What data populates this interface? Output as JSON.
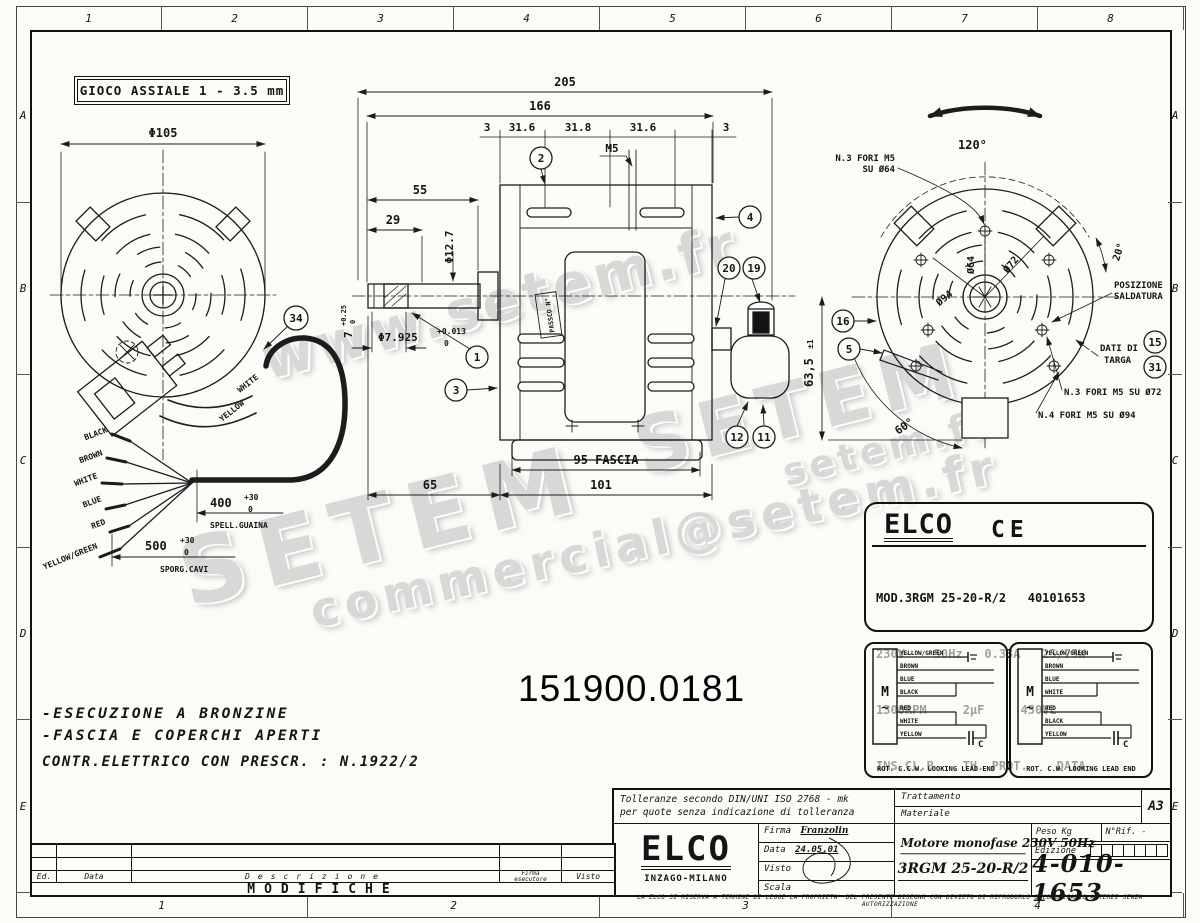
{
  "watermarks": {
    "w1": "www.setem.fr",
    "w2": "SETEM",
    "w3": "SETEM",
    "w4": "commercial@setem.fr",
    "w5": "setem.fr"
  },
  "border": {
    "top": [
      "1",
      "2",
      "3",
      "4",
      "5",
      "6",
      "7",
      "8"
    ],
    "bottom": [
      "1",
      "2",
      "3",
      "4"
    ],
    "left": [
      "A",
      "B",
      "C",
      "D",
      "E"
    ],
    "right": [
      "A",
      "B",
      "C",
      "D",
      "E"
    ]
  },
  "gioco": "GIOCO ASSIALE  1 - 3.5 mm",
  "part_number": "151900.0181",
  "notes": {
    "l1": "-ESECUZIONE A BRONZINE",
    "l2": "-FASCIA E COPERCHI APERTI",
    "l3": "CONTR.ELETTRICO CON PRESCR. : N.1922/2"
  },
  "left_view": {
    "dia": "Φ105",
    "callout34": "34",
    "terminal_white": "WHITE",
    "terminal_yellow": "YELLOW",
    "w1": "BLACK",
    "w2": "BROWN",
    "w3": "WHITE",
    "w4": "BLUE",
    "w5": "RED",
    "w6": "YELLOW/GREEN",
    "d400": {
      "v": "400",
      "up": "+30",
      "dn": "0",
      "label": "SPELL.GUAINA"
    },
    "d500": {
      "v": "500",
      "up": "+30",
      "dn": "0",
      "label": "SPORG.CAVI"
    }
  },
  "front_view": {
    "d205": "205",
    "d166": "166",
    "d3a": "3",
    "d316a": "31.6",
    "d318": "31.8",
    "d316b": "31.6",
    "d3b": "3",
    "m5": "M5",
    "d55": "55",
    "d29": "29",
    "d127": "Φ12.7",
    "shaft": {
      "v": "Φ7.925",
      "up": "+0.013",
      "dn": "0"
    },
    "key": {
      "v": "7",
      "up": "+0.25",
      "dn": "0"
    },
    "fascia": "95 FASCIA",
    "d65": "65",
    "d101": "101",
    "tag": "PASSCO N°",
    "c1": "1",
    "c2": "2",
    "c3": "3",
    "c4": "4",
    "c19": "19",
    "c20": "20",
    "c11": "11",
    "c12": "12"
  },
  "rear_view": {
    "a120": "120°",
    "a20": "20°",
    "a60": "60°",
    "d72": "Ø72",
    "d64": "Ø64",
    "d94": "Ø94",
    "d635": "63,5",
    "d635tol": "±1",
    "fori64a": "N.3 FORI M5",
    "fori64b": "SU Ø64",
    "pos1": "POSIZIONE",
    "pos2": "SALDATURA",
    "targa1": "DATI DI",
    "targa2": "TARGA",
    "fori72": "N.3 FORI M5 SU Ø72",
    "fori94": "N.4 FORI M5 SU Ø94",
    "c16": "16",
    "c5": "5",
    "c15": "15",
    "c31": "31"
  },
  "nameplate": {
    "brand": "ELCO",
    "ce": "CE",
    "l1": "MOD.3RGM 25-20-R/2   40101653",
    "l2": "230V~   50Hz   0.33A   25/75W",
    "l3": "1300RPM     2µF     450VL",
    "l4": "INS.CL.B    TH. PROT.    DATA"
  },
  "wiring": {
    "left": {
      "m": "M",
      "t": "~",
      "c": "C",
      "w1": "YELLOW/GREEN",
      "w2": "BROWN",
      "w3": "BLUE",
      "w4": "BLACK",
      "w5": "RED",
      "w6": "WHITE",
      "w7": "YELLOW",
      "caption": "ROT. C.C.W. LOOKING LEAD END"
    },
    "right": {
      "m": "M",
      "t": "~",
      "c": "C",
      "w1": "YELLOW/GREEN",
      "w2": "BROWN",
      "w3": "BLUE",
      "w4": "WHITE",
      "w5": "RED",
      "w6": "BLACK",
      "w7": "YELLOW",
      "caption": "ROT. C.W. LOOKING LEAD END"
    }
  },
  "title_block": {
    "tol1": "Tolleranze secondo DIN/UNI ISO 2768 - mk",
    "tol2": "per quote senza indicazione di tolleranza",
    "trattamento": "Trattamento",
    "materiale": "Materiale",
    "format": "A3",
    "brand": "ELCO",
    "brand_sub": "INZAGO-MILANO",
    "firma_label": "Firma",
    "firma": "Franzolin",
    "data_label": "Data",
    "data_value": "24.05.01",
    "visto_label": "Visto",
    "scala_label": "Scala",
    "title1": "Motore monofase 230V  50Hz",
    "title2": "3RGM 25-20-R/2",
    "peso": "Peso Kg",
    "nrif": "N°Rif. -",
    "edizione": "Edizione",
    "number": "4-010-1653",
    "legal": "LA ELCO SI RISERVA A TERMINE DI LEGGE LA PROPRIETA' DEL PRESENTE DISEGNO CON DIVIETO DI RIPRODURLO O COMUNICARLO A TERZI SENZA AUTORIZZAZIONE"
  },
  "modifiche": {
    "ed": "Ed.",
    "data": "Data",
    "descrizione": "Descrizione",
    "firma1": "Firma",
    "firma2": "esecutore",
    "visto": "Visto",
    "title": "MODIFICHE"
  }
}
